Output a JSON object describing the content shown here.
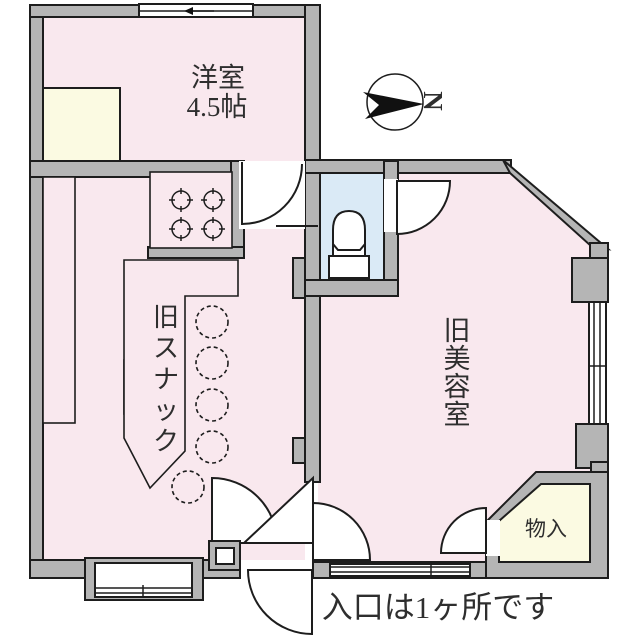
{
  "floorplan": {
    "rooms": {
      "western": {
        "label_line1": "洋室",
        "label_line2": "4.5帖"
      },
      "snack": {
        "label": "旧スナック"
      },
      "salon": {
        "label": "旧美容室"
      },
      "storage": {
        "label": "物入"
      }
    },
    "caption": "入口は1ヶ所です",
    "compass": {
      "north_label": "N"
    },
    "colors": {
      "floor_pink": "#f9e8ee",
      "wall_gray": "#b5b5b5",
      "closet_cream": "#fbfae2",
      "toilet_blue": "#daeaf6",
      "outline": "#1d1d1d"
    }
  }
}
